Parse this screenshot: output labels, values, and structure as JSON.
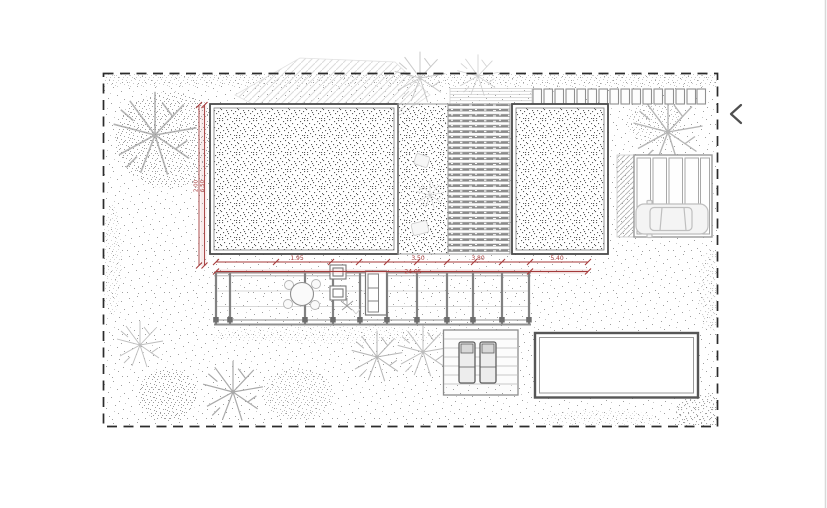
{
  "page": {
    "background": "#ffffff",
    "type": "architectural-site-plan-image"
  },
  "carousel": {
    "prev_icon": "chevron-left"
  },
  "drawing": {
    "colors": {
      "dimension_red": "#a43a3a",
      "boundary_black": "#2b2b2b",
      "structure_gray": "#8a8a8a",
      "car_gray": "#c2c2c2"
    },
    "dimensions": {
      "top_segments": [
        "1.95",
        "3.50",
        "3.80",
        "5.40"
      ],
      "overall_width": "24.05",
      "left_vertical": [
        "2.00",
        "6.50"
      ]
    },
    "features": [
      "planted-bed-left",
      "gravel-strip",
      "wood-deck",
      "planted-bed-right",
      "carport-with-car",
      "pergola-terrace",
      "dining-set",
      "sofa",
      "lounge-deck-with-sunbeds",
      "swimming-pool",
      "trees",
      "fence",
      "path"
    ]
  }
}
